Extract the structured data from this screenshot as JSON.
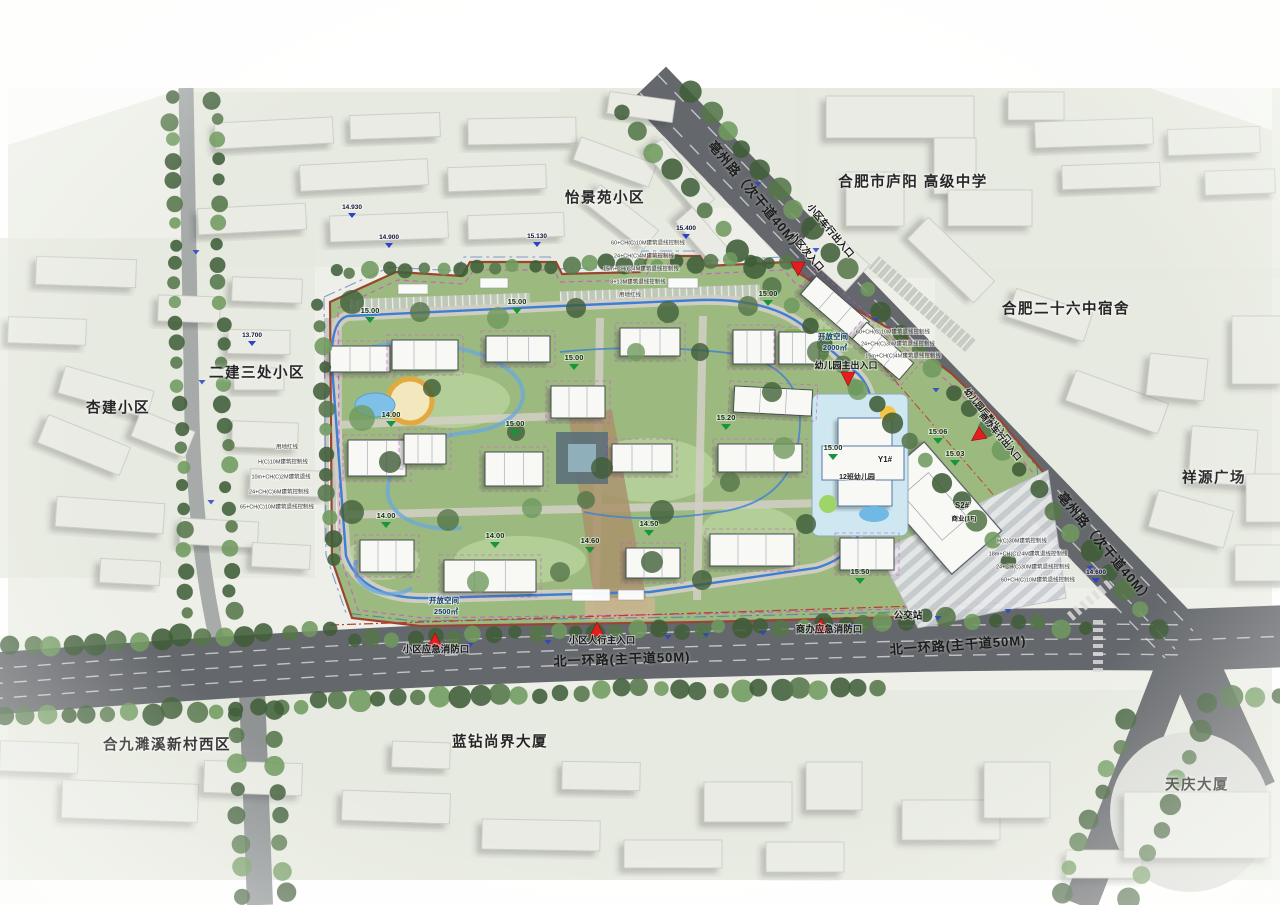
{
  "plan": {
    "colors": {
      "paper": "#edefe8",
      "road": "#64676b",
      "road_line": "#d9dbdd",
      "minor_road": "#9aa0a0",
      "tree_dark": "#41603a",
      "tree": "#55764a",
      "tree_light": "#6f9a5e",
      "site_green": "#9cba80",
      "lawn": "#b7d29b",
      "bright_lawn": "#8cc95d",
      "boundary_red": "#9c4433",
      "red_line": "#c0392b",
      "magenta": "#cf4fcf",
      "blue_parcel": "#3b5fc0",
      "blue_loop": "#3d7fd4",
      "water": "#7fc0e8",
      "building": "#f8f8f5",
      "context_building": "#e9ebe4",
      "entrance_red": "#e41e1e",
      "elev_green": "#18953c",
      "elev_blue": "#2b43c8",
      "kindergarten": "#cfe7f0",
      "axis_tan": "#a9926b"
    },
    "labels": {
      "districts": [
        {
          "text": "怡景苑小区",
          "x": 605,
          "y": 197
        },
        {
          "text": "合肥市庐阳 高级中学",
          "x": 913,
          "y": 181
        },
        {
          "text": "合肥二十六中宿舍",
          "x": 1066,
          "y": 308
        },
        {
          "text": "祥源广场",
          "x": 1214,
          "y": 477
        },
        {
          "text": "二建三处小区",
          "x": 257,
          "y": 372
        },
        {
          "text": "杏建小区",
          "x": 118,
          "y": 407
        },
        {
          "text": "合九濉溪新村西区",
          "x": 167,
          "y": 744
        },
        {
          "text": "蓝钻尚界大厦",
          "x": 500,
          "y": 741
        },
        {
          "text": "天庆大厦",
          "x": 1197,
          "y": 784
        }
      ],
      "roads": [
        {
          "text": "亳州路（次干道40M）",
          "x": 757,
          "y": 196,
          "rot": 50,
          "size": 13
        },
        {
          "text": "亳州路（次干道40M）",
          "x": 1106,
          "y": 547,
          "rot": 50,
          "size": 13
        },
        {
          "text": "北一环路(主干道50M)",
          "x": 622,
          "y": 658,
          "rot": -2,
          "size": 13
        },
        {
          "text": "北一环路(主干道50M)",
          "x": 958,
          "y": 644,
          "rot": -4,
          "size": 13
        }
      ],
      "entrances": [
        {
          "text": "小区车行出入口",
          "x": 830,
          "y": 231,
          "rot": 50,
          "size": 9.5
        },
        {
          "text": "小区次入口",
          "x": 806,
          "y": 252,
          "rot": 50,
          "size": 9.5
        },
        {
          "text": "幼儿园后勤出入口/",
          "x": 988,
          "y": 417,
          "rot": 50,
          "size": 8.5
        },
        {
          "text": "商办车行出入口",
          "x": 1000,
          "y": 437,
          "rot": 50,
          "size": 8.5
        },
        {
          "text": "幼儿园主出入口",
          "x": 846,
          "y": 366,
          "rot": 0,
          "size": 9
        },
        {
          "text": "小区人行主入口",
          "x": 602,
          "y": 641,
          "rot": 0,
          "size": 9.5
        },
        {
          "text": "小区应急消防口",
          "x": 436,
          "y": 650,
          "rot": 0,
          "size": 9.5
        },
        {
          "text": "商办应急消防口",
          "x": 829,
          "y": 630,
          "rot": 0,
          "size": 9.5
        },
        {
          "text": "公交站",
          "x": 908,
          "y": 616,
          "rot": 0,
          "size": 9.5
        }
      ],
      "site": [
        {
          "text": "Y1#",
          "x": 885,
          "y": 460,
          "size": 8
        },
        {
          "text": "12班幼儿园",
          "x": 857,
          "y": 477,
          "size": 7
        },
        {
          "text": "S2#",
          "x": 962,
          "y": 506,
          "size": 8
        },
        {
          "text": "商业(1F)",
          "x": 964,
          "y": 519,
          "size": 6.5
        },
        {
          "text": "开放空间",
          "x": 833,
          "y": 337,
          "size": 7.5
        },
        {
          "text": "2000㎡",
          "x": 835,
          "y": 348,
          "size": 7.5
        },
        {
          "text": "开放空间",
          "x": 444,
          "y": 601,
          "size": 7.5
        },
        {
          "text": "2500㎡",
          "x": 446,
          "y": 612,
          "size": 7.5
        }
      ],
      "notes": [
        {
          "text": "用地红线",
          "x": 287,
          "y": 447
        },
        {
          "text": "H(C)10M建筑控制线",
          "x": 283,
          "y": 462
        },
        {
          "text": "10m+CH(C)2M建筑退线",
          "x": 281,
          "y": 477
        },
        {
          "text": "24+CH(C)6M建筑控制线",
          "x": 279,
          "y": 492
        },
        {
          "text": "65+CH(C)10M建筑退线控制线",
          "x": 277,
          "y": 507
        },
        {
          "text": "60+CH(C)10M建筑退线控制线",
          "x": 648,
          "y": 243
        },
        {
          "text": "24+CH(C)4M建筑控制线",
          "x": 644,
          "y": 256
        },
        {
          "text": "15m+CH(C)4M建筑退线控制线",
          "x": 641,
          "y": 269
        },
        {
          "text": "8+13M建筑退线控制线",
          "x": 638,
          "y": 282
        },
        {
          "text": "用地红线",
          "x": 630,
          "y": 295
        },
        {
          "text": "60+CH(C)10M建筑退线控制线",
          "x": 893,
          "y": 332
        },
        {
          "text": "24+CH(C)30M建筑退线控制线",
          "x": 898,
          "y": 344
        },
        {
          "text": "15m+CH(C)4M建筑退线控制线",
          "x": 903,
          "y": 356
        },
        {
          "text": "H(C)30M建筑控制线",
          "x": 1022,
          "y": 541
        },
        {
          "text": "18m+CH(C)24M建筑退线控制线",
          "x": 1028,
          "y": 554
        },
        {
          "text": "24+CH(C)30M建筑退线控制线",
          "x": 1033,
          "y": 567
        },
        {
          "text": "60+CH(C)10M建筑退线控制线",
          "x": 1038,
          "y": 580
        }
      ],
      "elev_site": [
        {
          "v": "15.00",
          "x": 370,
          "y": 317
        },
        {
          "v": "15.00",
          "x": 517,
          "y": 308
        },
        {
          "v": "15.00",
          "x": 574,
          "y": 364
        },
        {
          "v": "15.00",
          "x": 768,
          "y": 300
        },
        {
          "v": "15.00",
          "x": 515,
          "y": 430
        },
        {
          "v": "14.00",
          "x": 391,
          "y": 421
        },
        {
          "v": "14.00",
          "x": 386,
          "y": 522
        },
        {
          "v": "14.00",
          "x": 495,
          "y": 542
        },
        {
          "v": "14.60",
          "x": 590,
          "y": 547
        },
        {
          "v": "14.50",
          "x": 649,
          "y": 530
        },
        {
          "v": "15.00",
          "x": 833,
          "y": 454
        },
        {
          "v": "15.06",
          "x": 938,
          "y": 438
        },
        {
          "v": "15.03",
          "x": 955,
          "y": 460
        },
        {
          "v": "15.20",
          "x": 726,
          "y": 424
        },
        {
          "v": "15.50",
          "x": 860,
          "y": 578
        }
      ],
      "elev_road": [
        {
          "v": "13.700",
          "x": 252,
          "y": 341
        },
        {
          "v": "14.930",
          "x": 352,
          "y": 213
        },
        {
          "v": "14.900",
          "x": 389,
          "y": 243
        },
        {
          "v": "15.130",
          "x": 537,
          "y": 242
        },
        {
          "v": "15.400",
          "x": 686,
          "y": 234
        },
        {
          "v": "14.600",
          "x": 1096,
          "y": 578
        }
      ]
    },
    "markers": {
      "entrance_triangles": [
        {
          "x": 798,
          "y": 268,
          "rot": 180
        },
        {
          "x": 848,
          "y": 378,
          "rot": 180
        },
        {
          "x": 978,
          "y": 436,
          "rot": 235
        },
        {
          "x": 597,
          "y": 630,
          "rot": 0
        },
        {
          "x": 435,
          "y": 641,
          "rot": 0
        },
        {
          "x": 821,
          "y": 626,
          "rot": 0
        }
      ],
      "road_ticks": [
        [
          470,
          643
        ],
        [
          548,
          640
        ],
        [
          612,
          637
        ],
        [
          668,
          635
        ],
        [
          706,
          633
        ],
        [
          763,
          631
        ],
        [
          852,
          624
        ],
        [
          938,
          616
        ],
        [
          1008,
          609
        ],
        [
          196,
          250
        ],
        [
          202,
          380
        ],
        [
          211,
          500
        ],
        [
          758,
          182
        ],
        [
          816,
          248
        ],
        [
          876,
          318
        ],
        [
          936,
          388
        ],
        [
          1090,
          566
        ]
      ]
    }
  }
}
